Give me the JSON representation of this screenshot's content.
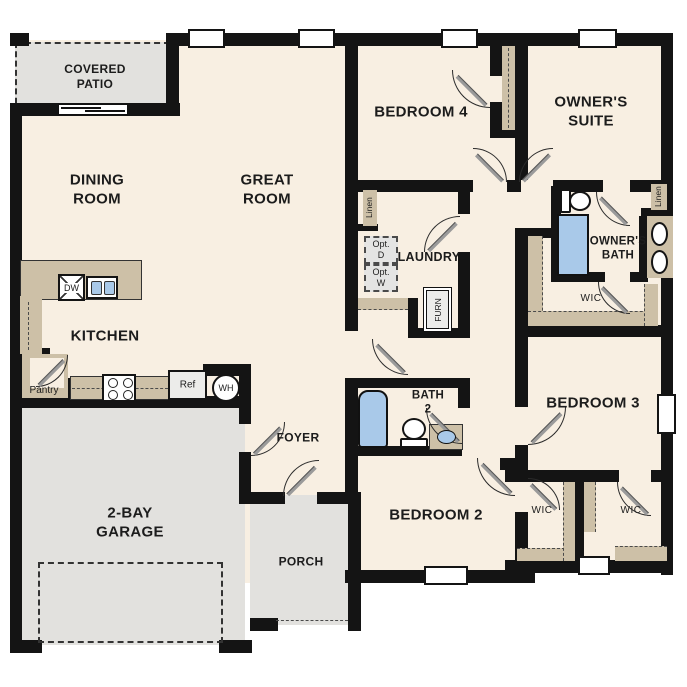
{
  "colors": {
    "wall": "#141414",
    "floor": "#f8efe2",
    "gray": "#e2e1de",
    "tan": "#cdc0a7",
    "blue": "#a9c9e9",
    "boxgray": "#e4e4e3",
    "ink": "#1c1c1c"
  },
  "rooms": {
    "covered_patio": "COVERED\nPATIO",
    "dining": "DINING\nROOM",
    "great": "GREAT\nROOM",
    "kitchen": "KITCHEN",
    "pantry": "Pantry",
    "foyer": "FOYER",
    "garage": "2-BAY\nGARAGE",
    "porch": "PORCH",
    "bedroom2": "BEDROOM 2",
    "bedroom3": "BEDROOM 3",
    "bedroom4": "BEDROOM 4",
    "bath2": "BATH\n2",
    "owners_suite": "OWNER'S\nSUITE",
    "owners_bath": "OWNER'S\nBATH",
    "laundry": "LAUNDRY",
    "wic_hall": "WIC",
    "wic_left": "WIC",
    "wic_right": "WIC"
  },
  "fixtures": {
    "dishwasher": "DW",
    "refrigerator": "Ref",
    "water_heater": "WH",
    "furnace": "FURN",
    "optional_dryer": "Opt.\nD",
    "optional_washer": "Opt.\nW",
    "linen_hall": "Linen",
    "linen_owners": "Linen"
  }
}
